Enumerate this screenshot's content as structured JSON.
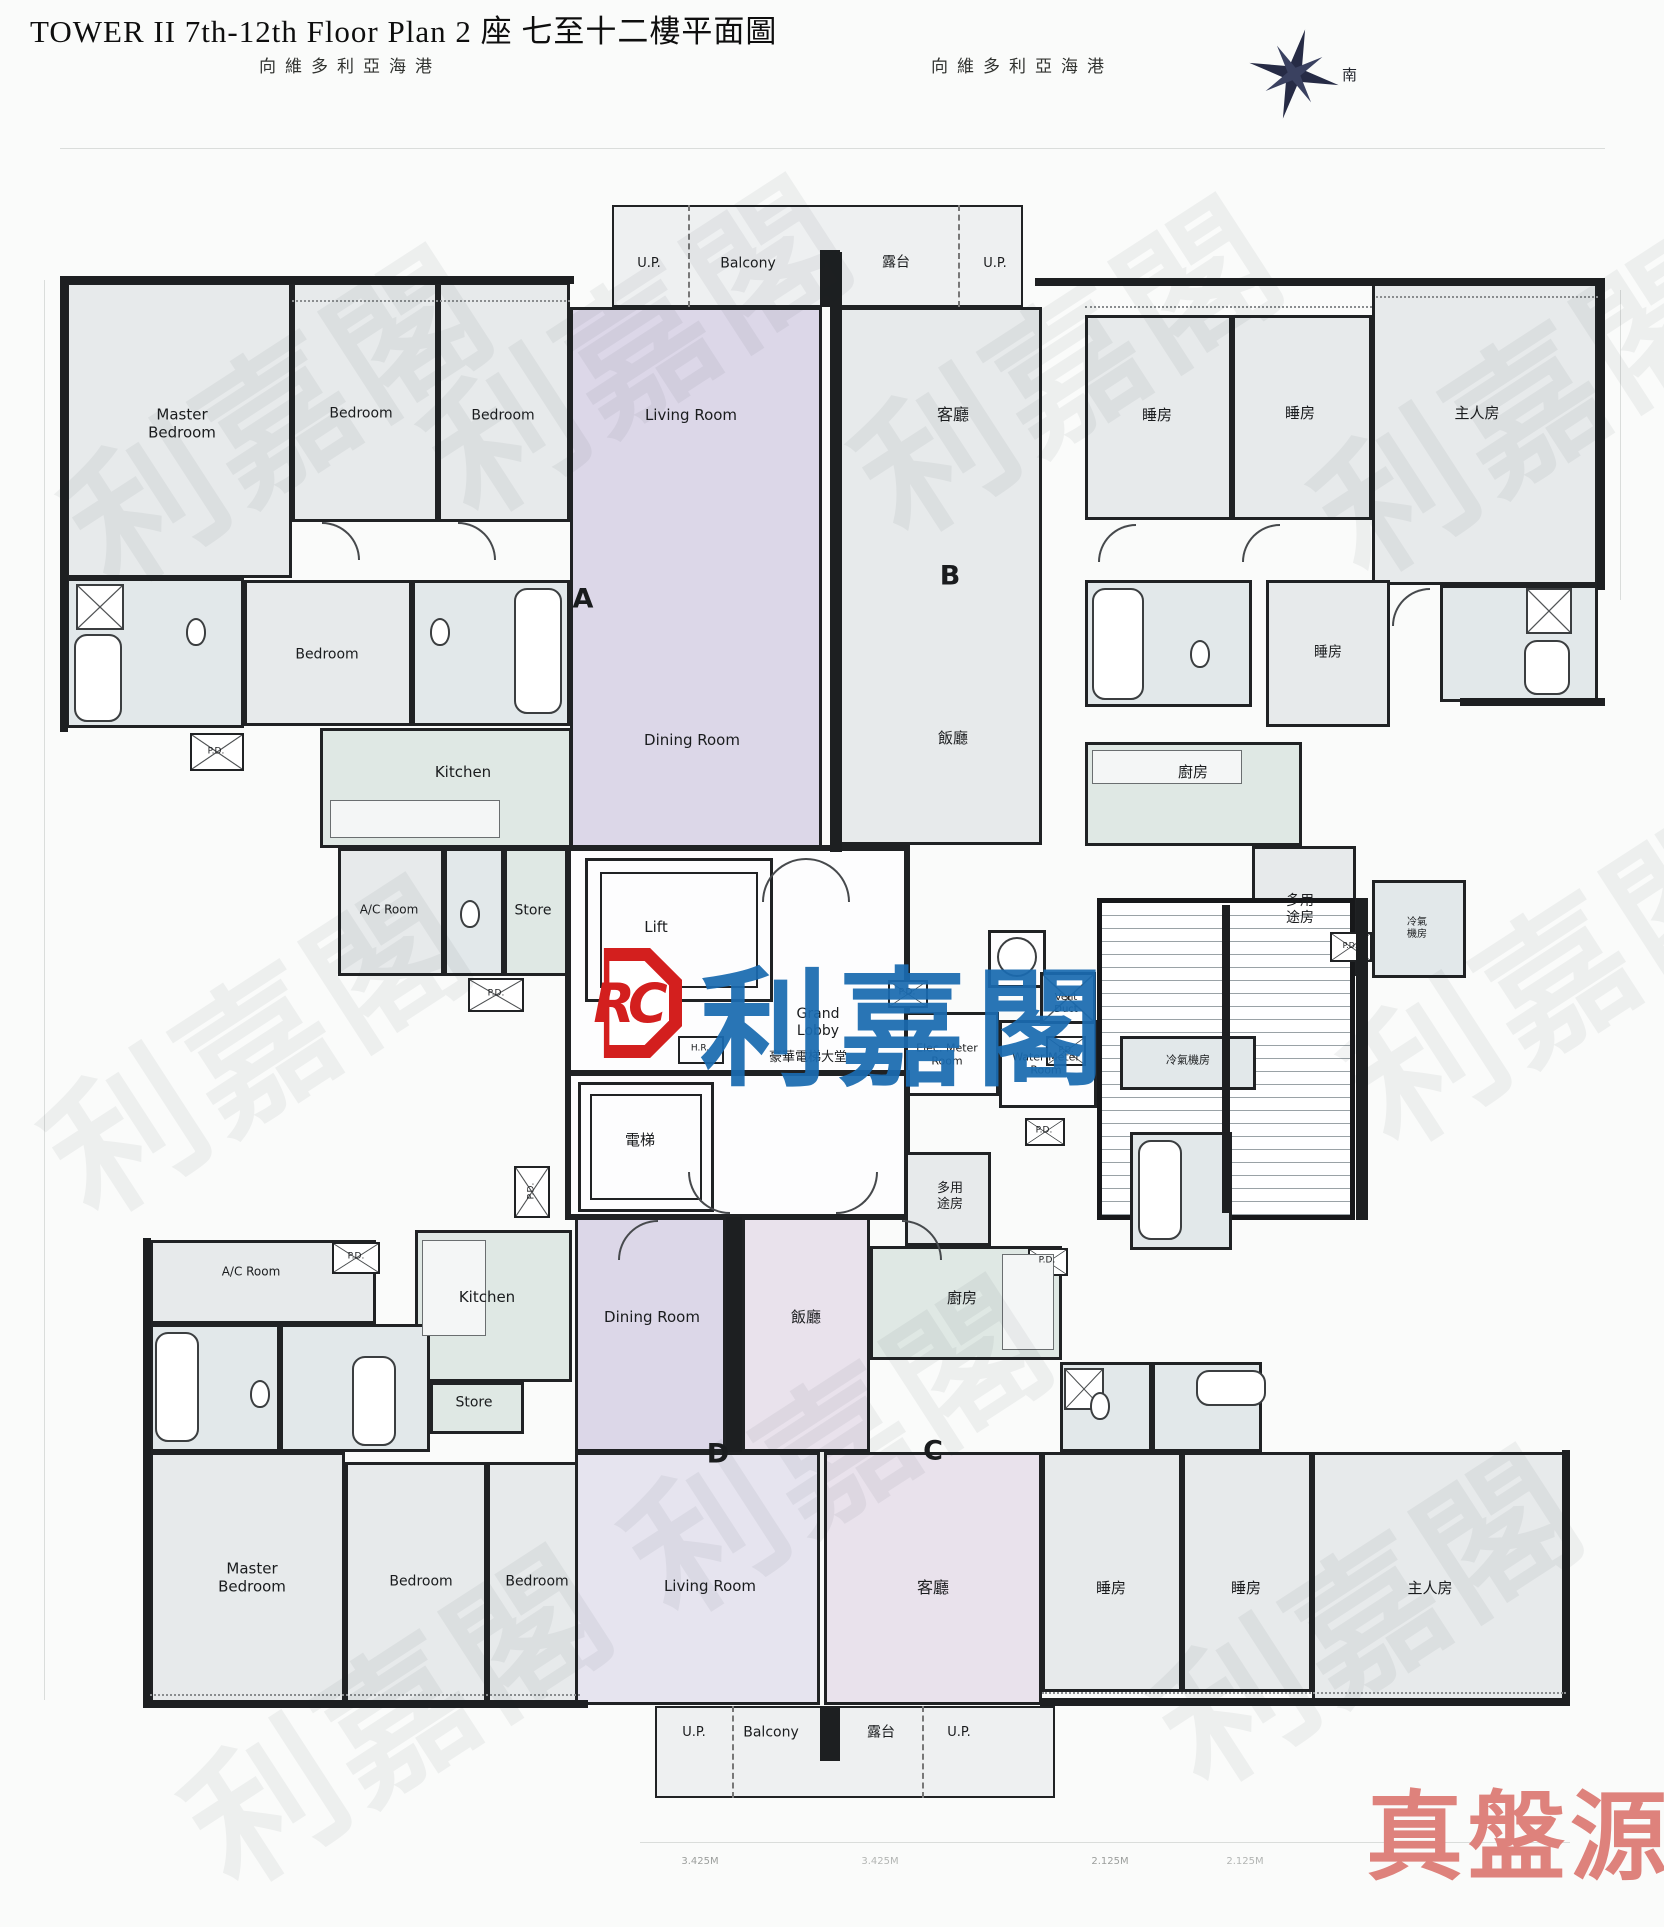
{
  "header": {
    "title": "TOWER II 7th-12th Floor Plan 2 座 七至十二樓平面圖",
    "harbour_left": "向維多利亞海港",
    "harbour_right": "向維多利亞海港",
    "compass_south": "南"
  },
  "branding": {
    "logo_rc": "RC",
    "logo_name": "利嘉閣",
    "footer_watermark": "真盤源",
    "watermark_repeat": "利嘉閣"
  },
  "labels": [
    {
      "n": "unit-a-letter",
      "t": "A",
      "x": 583,
      "y": 600,
      "s": 27,
      "b": 1
    },
    {
      "n": "master-bedroom-a",
      "t": "Master\nBedroom",
      "x": 182,
      "y": 424,
      "s": 15
    },
    {
      "n": "bedroom-a-top-1",
      "t": "Bedroom",
      "x": 361,
      "y": 414,
      "s": 14
    },
    {
      "n": "bedroom-a-top-2",
      "t": "Bedroom",
      "x": 503,
      "y": 416,
      "s": 14
    },
    {
      "n": "living-room-a",
      "t": "Living Room",
      "x": 691,
      "y": 415,
      "s": 15
    },
    {
      "n": "bedroom-a-mid",
      "t": "Bedroom",
      "x": 327,
      "y": 655,
      "s": 14
    },
    {
      "n": "kitchen-a",
      "t": "Kitchen",
      "x": 463,
      "y": 772,
      "s": 15
    },
    {
      "n": "dining-room-a",
      "t": "Dining Room",
      "x": 692,
      "y": 740,
      "s": 15
    },
    {
      "n": "ac-room-a",
      "t": "A/C Room",
      "x": 389,
      "y": 910,
      "s": 12
    },
    {
      "n": "store-a",
      "t": "Store",
      "x": 533,
      "y": 911,
      "s": 14
    },
    {
      "n": "pd-a-1",
      "t": "P.D.",
      "x": 216,
      "y": 752,
      "s": 9
    },
    {
      "n": "pd-a-2",
      "t": "P.D.",
      "x": 496,
      "y": 994,
      "s": 9
    },
    {
      "n": "up-top-left",
      "t": "U.P.",
      "x": 649,
      "y": 264,
      "s": 13
    },
    {
      "n": "balcony-top",
      "t": "Balcony",
      "x": 748,
      "y": 264,
      "s": 14
    },
    {
      "n": "terrace-top",
      "t": "露台",
      "x": 896,
      "y": 263,
      "s": 14
    },
    {
      "n": "up-top-right",
      "t": "U.P.",
      "x": 995,
      "y": 264,
      "s": 13
    },
    {
      "n": "unit-b-letter",
      "t": "B",
      "x": 950,
      "y": 577,
      "s": 27,
      "b": 1
    },
    {
      "n": "living-room-b",
      "t": "客廳",
      "x": 953,
      "y": 415,
      "s": 16
    },
    {
      "n": "bedroom-b-1",
      "t": "睡房",
      "x": 1157,
      "y": 415,
      "s": 15
    },
    {
      "n": "bedroom-b-2",
      "t": "睡房",
      "x": 1300,
      "y": 413,
      "s": 15
    },
    {
      "n": "master-bedroom-b",
      "t": "主人房",
      "x": 1477,
      "y": 413,
      "s": 15
    },
    {
      "n": "dining-room-b",
      "t": "飯廳",
      "x": 953,
      "y": 738,
      "s": 15
    },
    {
      "n": "bedroom-b-mid",
      "t": "睡房",
      "x": 1328,
      "y": 653,
      "s": 14
    },
    {
      "n": "kitchen-b",
      "t": "廚房",
      "x": 1193,
      "y": 772,
      "s": 15
    },
    {
      "n": "multi-room-b",
      "t": "多用\n途房",
      "x": 1300,
      "y": 910,
      "s": 14
    },
    {
      "n": "ac-plant-b",
      "t": "冷氣\n機房",
      "x": 1417,
      "y": 929,
      "s": 10
    },
    {
      "n": "pd-b",
      "t": "P.D.",
      "x": 1350,
      "y": 946,
      "s": 8
    },
    {
      "n": "lift-top",
      "t": "Lift",
      "x": 656,
      "y": 927,
      "s": 15
    },
    {
      "n": "hr-label",
      "t": "H.R.",
      "x": 700,
      "y": 1049,
      "s": 9
    },
    {
      "n": "grand-lobby",
      "t": "Grand\nLobby",
      "x": 818,
      "y": 1023,
      "s": 14
    },
    {
      "n": "grand-lobby-cn",
      "t": "豪華電梯大堂",
      "x": 808,
      "y": 1058,
      "s": 13
    },
    {
      "n": "pd-core-top",
      "t": "P.D.",
      "x": 907,
      "y": 993,
      "s": 9
    },
    {
      "n": "vent-duct",
      "t": "Vent\nDuct",
      "x": 1066,
      "y": 1004,
      "s": 10
    },
    {
      "n": "elec-meter-room",
      "t": "Elec. Meter\nRoom",
      "x": 947,
      "y": 1055,
      "s": 11
    },
    {
      "n": "water-meter-room",
      "t": "Water Meter\nRoom",
      "x": 1046,
      "y": 1064,
      "s": 11
    },
    {
      "n": "lift-bottom",
      "t": "電梯",
      "x": 640,
      "y": 1140,
      "s": 15
    },
    {
      "n": "pd-core-b1",
      "t": "P.D.",
      "x": 1044,
      "y": 1131,
      "s": 9
    },
    {
      "n": "pd-core-b2",
      "t": "P.D.",
      "x": 1047,
      "y": 1261,
      "s": 9
    },
    {
      "n": "unit-d-letter",
      "t": "D",
      "x": 718,
      "y": 1455,
      "s": 27,
      "b": 1
    },
    {
      "n": "ac-room-d",
      "t": "A/C Room",
      "x": 251,
      "y": 1272,
      "s": 12
    },
    {
      "n": "kitchen-d",
      "t": "Kitchen",
      "x": 487,
      "y": 1297,
      "s": 15
    },
    {
      "n": "pd-d-1",
      "t": "P.D.",
      "x": 356,
      "y": 1257,
      "s": 9
    },
    {
      "n": "pd-d-2",
      "t": "P.D.",
      "x": 532,
      "y": 1191,
      "s": 9,
      "r": -90
    },
    {
      "n": "store-d",
      "t": "Store",
      "x": 474,
      "y": 1403,
      "s": 14
    },
    {
      "n": "dining-room-d",
      "t": "Dining Room",
      "x": 652,
      "y": 1317,
      "s": 15
    },
    {
      "n": "living-room-d",
      "t": "Living Room",
      "x": 710,
      "y": 1586,
      "s": 15
    },
    {
      "n": "master-bedroom-d",
      "t": "Master\nBedroom",
      "x": 252,
      "y": 1578,
      "s": 15
    },
    {
      "n": "bedroom-d-1",
      "t": "Bedroom",
      "x": 421,
      "y": 1582,
      "s": 14
    },
    {
      "n": "bedroom-d-2",
      "t": "Bedroom",
      "x": 537,
      "y": 1582,
      "s": 14
    },
    {
      "n": "unit-c-letter",
      "t": "C",
      "x": 933,
      "y": 1452,
      "s": 27,
      "b": 1
    },
    {
      "n": "multi-room-c",
      "t": "多用\n途房",
      "x": 950,
      "y": 1197,
      "s": 13
    },
    {
      "n": "ac-plant-c",
      "t": "冷氣機房",
      "x": 1188,
      "y": 1060,
      "s": 11
    },
    {
      "n": "pd-c",
      "t": "P.D.",
      "x": 1066,
      "y": 1050,
      "s": 8
    },
    {
      "n": "kitchen-c",
      "t": "廚房",
      "x": 962,
      "y": 1298,
      "s": 15
    },
    {
      "n": "dining-room-c",
      "t": "飯廳",
      "x": 806,
      "y": 1317,
      "s": 15
    },
    {
      "n": "living-room-c",
      "t": "客廳",
      "x": 933,
      "y": 1588,
      "s": 16
    },
    {
      "n": "bedroom-c-1",
      "t": "睡房",
      "x": 1111,
      "y": 1588,
      "s": 15
    },
    {
      "n": "bedroom-c-2",
      "t": "睡房",
      "x": 1246,
      "y": 1588,
      "s": 15
    },
    {
      "n": "master-bedroom-c",
      "t": "主人房",
      "x": 1430,
      "y": 1588,
      "s": 15
    },
    {
      "n": "up-bottom-left",
      "t": "U.P.",
      "x": 694,
      "y": 1733,
      "s": 13
    },
    {
      "n": "balcony-bottom",
      "t": "Balcony",
      "x": 771,
      "y": 1733,
      "s": 14
    },
    {
      "n": "terrace-bottom",
      "t": "露台",
      "x": 881,
      "y": 1733,
      "s": 14
    },
    {
      "n": "up-bottom-right",
      "t": "U.P.",
      "x": 959,
      "y": 1733,
      "s": 13
    },
    {
      "n": "dim-bottom-1",
      "t": "3.425M",
      "x": 700,
      "y": 1862,
      "s": 10,
      "c": "dim"
    },
    {
      "n": "dim-bottom-2",
      "t": "3.425M",
      "x": 880,
      "y": 1862,
      "s": 10,
      "c": "dim faint"
    },
    {
      "n": "dim-bottom-3",
      "t": "2.125M",
      "x": 1110,
      "y": 1862,
      "s": 10,
      "c": "dim"
    },
    {
      "n": "dim-bottom-4",
      "t": "2.125M",
      "x": 1245,
      "y": 1862,
      "s": 10,
      "c": "dim faint"
    }
  ]
}
